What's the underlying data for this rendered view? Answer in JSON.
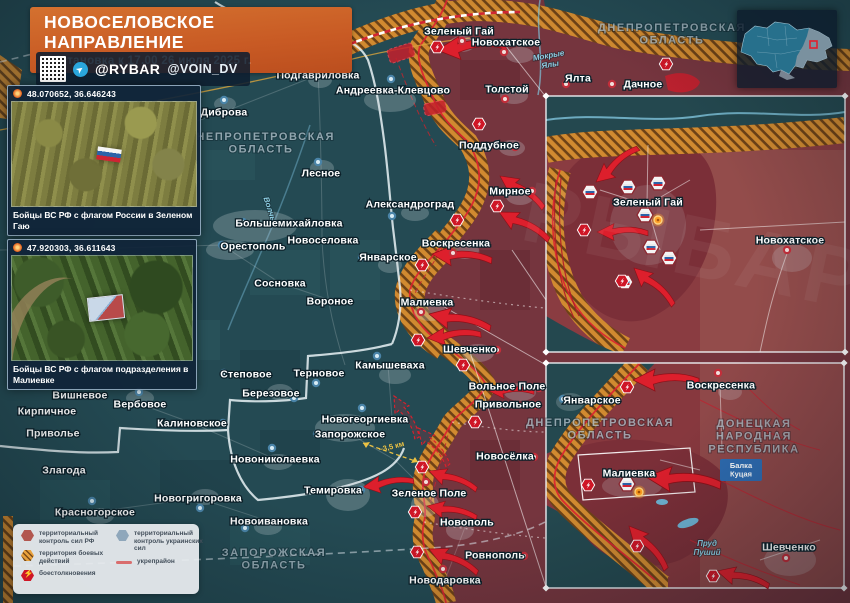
{
  "header": {
    "title": "НОВОСЕЛОВСКОЕ НАПРАВЛЕНИЕ",
    "subtitle": "Обстановка к 17.00 26 июля 2025 г.",
    "handle1": "@RYBAR",
    "handle2": "@VOIN_DV"
  },
  "photos": [
    {
      "coords": "48.070652, 36.646243",
      "caption": "Бойцы ВС РФ с флагом России в Зеленом Гаю"
    },
    {
      "coords": "47.920303, 36.611643",
      "caption": "Бойцы ВС РФ с флагом подразделения в Малиевке"
    }
  ],
  "legend": {
    "items": [
      {
        "label": "территориальный контроль сил РФ"
      },
      {
        "label": "территория боевых действий"
      },
      {
        "label": "боестолкновения"
      },
      {
        "label": "территориальный контроль украинских сил"
      },
      {
        "label": "укрепрайон"
      }
    ]
  },
  "watermark": "РЫБАРЬ",
  "colors": {
    "accent_orange": "#c85a24",
    "rf_zone": "#7c343c",
    "battle_zone": "#d18a30",
    "arrow_red": "#dd1f2c",
    "map_teal": "#244a53",
    "balka_blue": "#2e6cb2"
  },
  "map": {
    "region_labels": [
      {
        "text": "ДНЕПРОПЕТРОВСКАЯ\nОБЛАСТЬ",
        "x": 261,
        "y": 140,
        "size": 11
      },
      {
        "text": "ДНЕПРОПЕТРОВСКАЯ\nОБЛАСТЬ",
        "x": 672,
        "y": 31,
        "size": 10.5
      },
      {
        "text": "ЗАПОРОЖСКАЯ\nОБЛАСТЬ",
        "x": 274,
        "y": 556,
        "size": 11
      },
      {
        "text": "ДНЕПРОПЕТРОВСКАЯ\nОБЛАСТЬ",
        "x": 600,
        "y": 426,
        "size": 8.5
      },
      {
        "text": "ДОНЕЦКАЯ\nНАРОДНАЯ\nРЕСПУБЛИКА",
        "x": 754,
        "y": 427,
        "size": 9.5
      }
    ],
    "water_labels": [
      {
        "text": "Мокрые\nЯлы",
        "x": 549,
        "y": 58,
        "rot": -10
      },
      {
        "text": "Волчья",
        "x": 268,
        "y": 212,
        "rot": 72
      },
      {
        "text": "Пруд\nПуший",
        "x": 707,
        "y": 546,
        "rot": 0
      }
    ],
    "towns": [
      {
        "name": "Подгавриловка",
        "x": 318,
        "y": 75,
        "dot": {
          "x": 316,
          "y": 65,
          "c": "b"
        }
      },
      {
        "name": "Диброва",
        "x": 224,
        "y": 112,
        "dot": {
          "x": 224,
          "y": 100,
          "c": "b"
        }
      },
      {
        "name": "Андреевка-Клевцово",
        "x": 393,
        "y": 90,
        "dot": {
          "x": 391,
          "y": 79,
          "c": "b"
        }
      },
      {
        "name": "Зеленый Гай",
        "x": 459,
        "y": 31,
        "dot": {
          "x": 462,
          "y": 41,
          "c": "r"
        }
      },
      {
        "name": "Новохатское",
        "x": 506,
        "y": 42,
        "dot": {
          "x": 504,
          "y": 52,
          "c": "r"
        }
      },
      {
        "name": "Толстой",
        "x": 507,
        "y": 89,
        "dot": {
          "x": 505,
          "y": 99,
          "c": "r"
        }
      },
      {
        "name": "Ялта",
        "x": 578,
        "y": 78,
        "dot": {
          "x": 566,
          "y": 84,
          "c": "r"
        }
      },
      {
        "name": "Дачное",
        "x": 643,
        "y": 84,
        "dot": {
          "x": 612,
          "y": 84,
          "c": "r"
        }
      },
      {
        "name": "Лесное",
        "x": 321,
        "y": 173,
        "dot": {
          "x": 318,
          "y": 162,
          "c": "b"
        }
      },
      {
        "name": "Александроград",
        "x": 410,
        "y": 204,
        "dot": {
          "x": 392,
          "y": 216,
          "c": "b"
        }
      },
      {
        "name": "Большемихайловка",
        "x": 289,
        "y": 223,
        "dot": {
          "x": 243,
          "y": 222,
          "c": "b"
        }
      },
      {
        "name": "Орестополь",
        "x": 253,
        "y": 246,
        "dot": {
          "x": 222,
          "y": 245,
          "c": "b"
        }
      },
      {
        "name": "Новоселовка",
        "x": 323,
        "y": 240
      },
      {
        "name": "Январское",
        "x": 388,
        "y": 257,
        "dot": {
          "x": 362,
          "y": 257,
          "c": "b"
        }
      },
      {
        "name": "Сосновка",
        "x": 280,
        "y": 283
      },
      {
        "name": "Вороное",
        "x": 330,
        "y": 301
      },
      {
        "name": "Поддубное",
        "x": 489,
        "y": 145,
        "dot": {
          "x": 515,
          "y": 147,
          "c": "r"
        }
      },
      {
        "name": "Мирное",
        "x": 510,
        "y": 191,
        "dot": {
          "x": 532,
          "y": 191,
          "c": "r"
        }
      },
      {
        "name": "Воскресенка",
        "x": 456,
        "y": 243,
        "dot": {
          "x": 453,
          "y": 253,
          "c": "r"
        }
      },
      {
        "name": "Малиевка",
        "x": 427,
        "y": 302,
        "dot": {
          "x": 421,
          "y": 312,
          "c": "r"
        }
      },
      {
        "name": "Шевченко",
        "x": 470,
        "y": 349,
        "dot": {
          "x": 497,
          "y": 350,
          "c": "r"
        }
      },
      {
        "name": "Камышеваха",
        "x": 390,
        "y": 365,
        "dot": {
          "x": 377,
          "y": 356,
          "c": "b"
        }
      },
      {
        "name": "Терновое",
        "x": 319,
        "y": 373,
        "dot": {
          "x": 316,
          "y": 383,
          "c": "b"
        }
      },
      {
        "name": "Степовое",
        "x": 246,
        "y": 374,
        "dot": {
          "x": 224,
          "y": 373,
          "c": "b"
        }
      },
      {
        "name": "Вольное Поле",
        "x": 507,
        "y": 386,
        "dot": {
          "x": 539,
          "y": 388,
          "c": "r"
        }
      },
      {
        "name": "Привольное",
        "x": 508,
        "y": 404,
        "dot": {
          "x": 537,
          "y": 405,
          "c": "r"
        }
      },
      {
        "name": "Новогеоргиевка",
        "x": 365,
        "y": 419,
        "dot": {
          "x": 362,
          "y": 408,
          "c": "b"
        }
      },
      {
        "name": "Запорожское",
        "x": 350,
        "y": 434,
        "dot": {
          "x": 317,
          "y": 434,
          "c": "b"
        }
      },
      {
        "name": "Новосёлка",
        "x": 505,
        "y": 456,
        "dot": {
          "x": 534,
          "y": 457,
          "c": "r"
        }
      },
      {
        "name": "Темировка",
        "x": 333,
        "y": 490,
        "dot": {
          "x": 361,
          "y": 490,
          "c": "b"
        }
      },
      {
        "name": "Зеленое Поле",
        "x": 429,
        "y": 493,
        "dot": {
          "x": 426,
          "y": 482,
          "c": "r"
        }
      },
      {
        "name": "Новополь",
        "x": 467,
        "y": 522,
        "dot": {
          "x": 444,
          "y": 522,
          "c": "r"
        }
      },
      {
        "name": "Ровнополь",
        "x": 495,
        "y": 555,
        "dot": {
          "x": 524,
          "y": 556,
          "c": "r"
        }
      },
      {
        "name": "Новодаровка",
        "x": 445,
        "y": 580,
        "dot": {
          "x": 443,
          "y": 569,
          "c": "r"
        }
      },
      {
        "name": "Новоивановка",
        "x": 269,
        "y": 521,
        "dot": {
          "x": 245,
          "y": 528,
          "c": "b"
        }
      },
      {
        "name": "Вишневое",
        "x": 80,
        "y": 395,
        "dot": {
          "x": 57,
          "y": 394,
          "c": "b"
        }
      },
      {
        "name": "Вербовое",
        "x": 140,
        "y": 404,
        "dot": {
          "x": 139,
          "y": 392,
          "c": "b"
        }
      },
      {
        "name": "Березовое",
        "x": 271,
        "y": 393,
        "dot": {
          "x": 294,
          "y": 398,
          "c": "b"
        }
      },
      {
        "name": "Кирпичное",
        "x": 47,
        "y": 411,
        "dot": {
          "x": 21,
          "y": 411,
          "c": "b"
        }
      },
      {
        "name": "Калиновское",
        "x": 192,
        "y": 423,
        "dot": {
          "x": 223,
          "y": 423,
          "c": "b"
        }
      },
      {
        "name": "Новониколаевка",
        "x": 275,
        "y": 459,
        "dot": {
          "x": 272,
          "y": 448,
          "c": "b"
        }
      },
      {
        "name": "Приволье",
        "x": 53,
        "y": 433
      },
      {
        "name": "Злагода",
        "x": 64,
        "y": 470
      },
      {
        "name": "Новогригоровка",
        "x": 198,
        "y": 498,
        "dot": {
          "x": 200,
          "y": 508,
          "c": "b"
        }
      },
      {
        "name": "Красногорское",
        "x": 95,
        "y": 512,
        "dot": {
          "x": 92,
          "y": 501,
          "c": "b"
        }
      },
      {
        "name": "Зеленый Гай",
        "x": 648,
        "y": 202
      },
      {
        "name": "Новохатское",
        "x": 790,
        "y": 240,
        "dot": {
          "x": 787,
          "y": 250,
          "c": "r"
        }
      },
      {
        "name": "Январское",
        "x": 592,
        "y": 400,
        "dot": {
          "x": 563,
          "y": 399,
          "c": "b"
        }
      },
      {
        "name": "Воскресенка",
        "x": 721,
        "y": 385,
        "dot": {
          "x": 718,
          "y": 373,
          "c": "r"
        }
      },
      {
        "name": "Малиевка",
        "x": 629,
        "y": 473
      },
      {
        "name": "Шевченко",
        "x": 789,
        "y": 547,
        "dot": {
          "x": 786,
          "y": 558,
          "c": "r"
        }
      }
    ],
    "clash_icons": [
      {
        "x": 437,
        "y": 47
      },
      {
        "x": 479,
        "y": 124
      },
      {
        "x": 497,
        "y": 206
      },
      {
        "x": 457,
        "y": 220
      },
      {
        "x": 422,
        "y": 265
      },
      {
        "x": 418,
        "y": 340
      },
      {
        "x": 463,
        "y": 365
      },
      {
        "x": 475,
        "y": 422
      },
      {
        "x": 422,
        "y": 467
      },
      {
        "x": 415,
        "y": 512
      },
      {
        "x": 417,
        "y": 552
      },
      {
        "x": 666,
        "y": 64
      },
      {
        "x": 584,
        "y": 230
      },
      {
        "x": 622,
        "y": 281
      },
      {
        "x": 627,
        "y": 387
      },
      {
        "x": 588,
        "y": 485
      },
      {
        "x": 637,
        "y": 546
      },
      {
        "x": 713,
        "y": 576
      }
    ],
    "flag_icons": [
      {
        "x": 590,
        "y": 192
      },
      {
        "x": 628,
        "y": 187
      },
      {
        "x": 658,
        "y": 183
      },
      {
        "x": 645,
        "y": 215
      },
      {
        "x": 651,
        "y": 247
      },
      {
        "x": 669,
        "y": 258
      },
      {
        "x": 625,
        "y": 282
      },
      {
        "x": 627,
        "y": 484
      }
    ],
    "orange_markers": [
      {
        "x": 658,
        "y": 220
      },
      {
        "x": 639,
        "y": 492
      }
    ],
    "arrows": [
      {
        "x": 437,
        "y": 50,
        "rot": -5,
        "s": 1.15
      },
      {
        "x": 500,
        "y": 176,
        "rot": 35,
        "s": 0.9
      },
      {
        "x": 499,
        "y": 212,
        "rot": 28,
        "s": 0.95
      },
      {
        "x": 432,
        "y": 254,
        "rot": 5,
        "s": 1.0
      },
      {
        "x": 429,
        "y": 314,
        "rot": 12,
        "s": 1.05
      },
      {
        "x": 427,
        "y": 338,
        "rot": -5,
        "s": 0.9
      },
      {
        "x": 489,
        "y": 391,
        "rot": 0,
        "s": 0.75
      },
      {
        "x": 429,
        "y": 471,
        "rot": 20,
        "s": 0.85
      },
      {
        "x": 427,
        "y": 506,
        "rot": 12,
        "s": 0.85
      },
      {
        "x": 429,
        "y": 549,
        "rot": 25,
        "s": 0.9
      },
      {
        "x": 363,
        "y": 487,
        "rot": -8,
        "s": 0.85
      },
      {
        "x": 394,
        "y": 396,
        "rot": 60,
        "s": 0.8,
        "dashed": true
      },
      {
        "x": 418,
        "y": 428,
        "rot": 50,
        "s": 0.8,
        "dashed": true
      },
      {
        "x": 596,
        "y": 182,
        "rot": -40,
        "s": 0.9
      },
      {
        "x": 597,
        "y": 232,
        "rot": 0,
        "s": 0.85
      },
      {
        "x": 634,
        "y": 268,
        "rot": 42,
        "s": 0.9
      },
      {
        "x": 633,
        "y": 380,
        "rot": 0,
        "s": 1.1
      },
      {
        "x": 646,
        "y": 477,
        "rot": 5,
        "s": 1.25
      },
      {
        "x": 629,
        "y": 526,
        "rot": 48,
        "s": 0.95
      },
      {
        "x": 717,
        "y": 571,
        "rot": 15,
        "s": 0.9
      }
    ],
    "distance_label": {
      "text": "~3,5 км",
      "x": 392,
      "y": 449,
      "rot": -14
    },
    "balka_label": {
      "text": "Балка\nКуцая",
      "x": 741,
      "y": 468
    }
  }
}
